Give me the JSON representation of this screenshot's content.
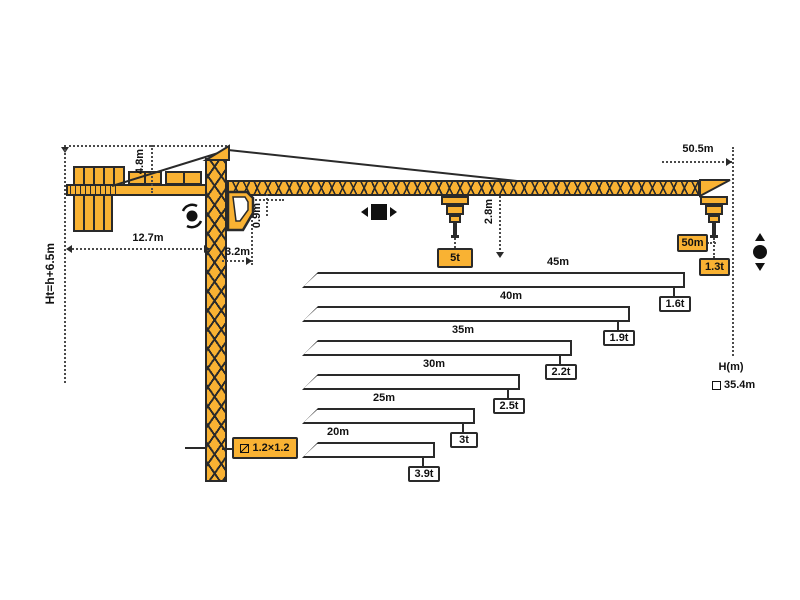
{
  "diagram": {
    "type": "tower-crane-specification-diagram",
    "colors": {
      "crane": "#F9B233",
      "outline": "#2A2A2A",
      "highlight_box": "#F9B233"
    },
    "dimensions": {
      "total_height_formula": "Ht=h+6.5m",
      "apex_height": "4.8m",
      "counter_jib_length": "12.7m",
      "slew_to_jib": "3.2m",
      "jib_section_depth": "0.9m",
      "hook_drop": "2.8m",
      "max_radius": "50.5m"
    },
    "callouts": {
      "max_load": "5t",
      "tip_radius": "50m",
      "tip_load": "1.3t",
      "mast_section": "1.2×1.2",
      "height_axis_label": "H(m)",
      "freestanding_height": "35.4m"
    },
    "load_chart": {
      "type": "bar",
      "description": "jib length vs tip load capacity",
      "rows": [
        {
          "length": "45m",
          "capacity": "1.6t"
        },
        {
          "length": "40m",
          "capacity": "1.9t"
        },
        {
          "length": "35m",
          "capacity": "2.2t"
        },
        {
          "length": "30m",
          "capacity": "2.5t"
        },
        {
          "length": "25m",
          "capacity": "3t"
        },
        {
          "length": "20m",
          "capacity": "3.9t"
        }
      ]
    }
  }
}
